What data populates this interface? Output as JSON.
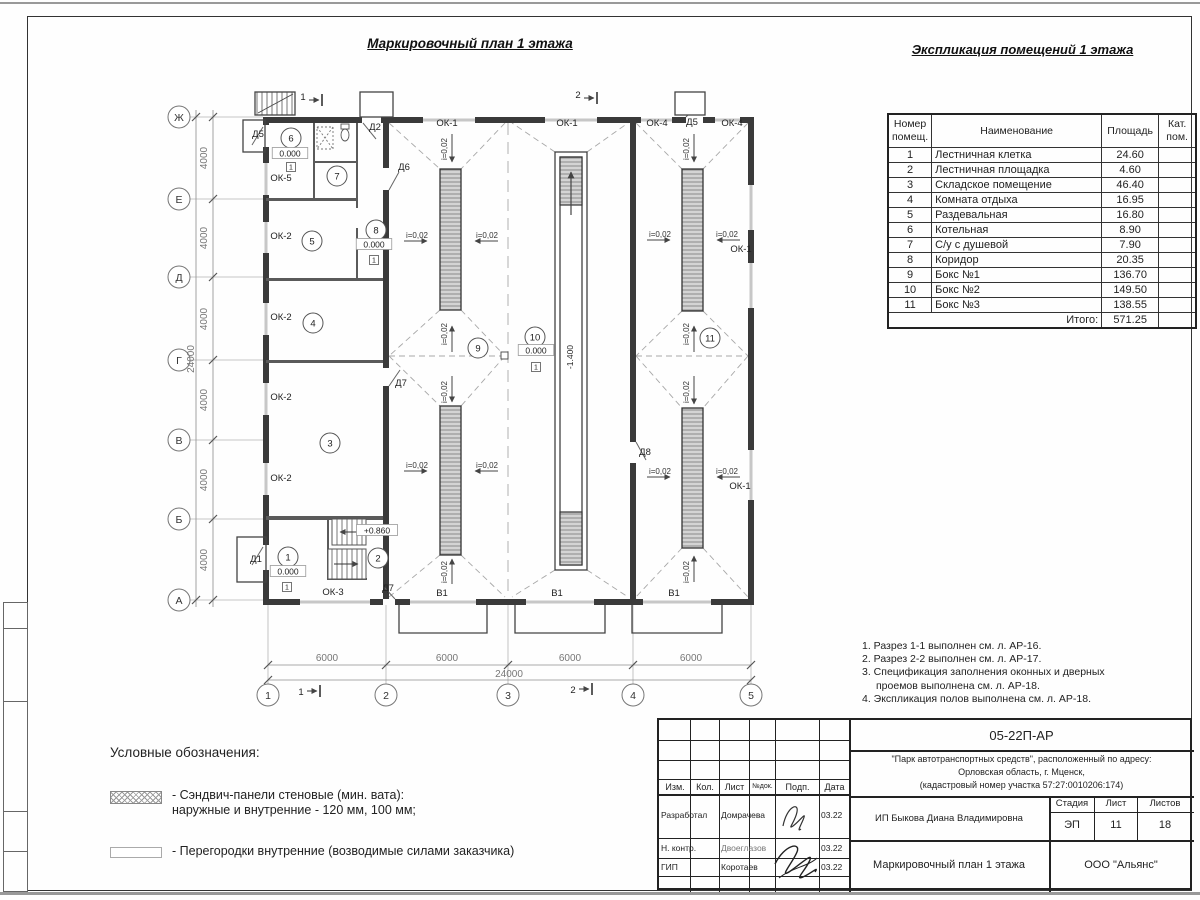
{
  "page": {
    "plan_title": "Маркировочный план 1 этажа",
    "expl_title": "Экспликация помещений 1 этажа"
  },
  "expl_table": {
    "headers": [
      "Номер помещ.",
      "Наименование",
      "Площадь",
      "Кат. пом."
    ],
    "rows": [
      [
        "1",
        "Лестничная клетка",
        "24.60"
      ],
      [
        "2",
        "Лестничная площадка",
        "4.60"
      ],
      [
        "3",
        "Складское помещение",
        "46.40"
      ],
      [
        "4",
        "Комната отдыха",
        "16.95"
      ],
      [
        "5",
        "Раздевальная",
        "16.80"
      ],
      [
        "6",
        "Котельная",
        "8.90"
      ],
      [
        "7",
        "С/у с душевой",
        "7.90"
      ],
      [
        "8",
        "Коридор",
        "20.35"
      ],
      [
        "9",
        "Бокс №1",
        "136.70"
      ],
      [
        "10",
        "Бокс №2",
        "149.50"
      ],
      [
        "11",
        "Бокс №3",
        "138.55"
      ]
    ],
    "total_label": "Итого:",
    "total_value": "571.25"
  },
  "notes": [
    "1. Разрез 1-1 выполнен см. л. АР-16.",
    "2. Разрез 2-2 выполнен см. л. АР-17.",
    "3. Спецификация заполнения оконных и дверных",
    "проемов выполнена см. л. АР-18.",
    "4. Экспликация полов выполнена см. л. АР-18."
  ],
  "legend": {
    "title": "Условные обозначения:",
    "item1_line1": "- Сэндвич-панели стеновые (мин. вата):",
    "item1_line2": "наружные и внутренние - 120 мм, 100 мм;",
    "item2": "- Перегородки внутренние (возводимые силами заказчика)"
  },
  "titleblock": {
    "doc_number": "05-22П-АР",
    "project_line1": "\"Парк автотранспортных средств\",  расположенный по адресу:",
    "project_line2": "Орловская область, г. Мценск,",
    "project_line3": "(кадастровый номер участка 57:27:0010206:174)",
    "client": "ИП Быкова Диана Владимировна",
    "sheet_title": "Маркировочный план 1 этажа",
    "company": "ООО \"Альянс\"",
    "cols": [
      "Изм.",
      "Кол.",
      "Лист",
      "№док.",
      "Подп.",
      "Дата"
    ],
    "stage_label": "Стадия",
    "sheet_label": "Лист",
    "sheets_label": "Листов",
    "stage": "ЭП",
    "sheet_no": "11",
    "sheets_total": "18",
    "people": [
      {
        "role": "Разработал",
        "name": "Домрачева",
        "date": "03.22"
      },
      {
        "role": "Н. контр.",
        "name": "Двоеглазов",
        "date": "03.22"
      },
      {
        "role": "ГИП",
        "name": "Коротаев",
        "date": "03.22"
      }
    ]
  },
  "plan": {
    "axes_rows": [
      [
        "Ж",
        117
      ],
      [
        "Е",
        199
      ],
      [
        "Д",
        277
      ],
      [
        "Г",
        360
      ],
      [
        "В",
        440
      ],
      [
        "Б",
        519
      ],
      [
        "А",
        600
      ]
    ],
    "axes_cols": [
      [
        "1",
        268
      ],
      [
        "2",
        386
      ],
      [
        "3",
        508
      ],
      [
        "4",
        633
      ],
      [
        "5",
        751
      ]
    ],
    "dims_v": [
      [
        "4000",
        207,
        158
      ],
      [
        "4000",
        207,
        238
      ],
      [
        "4000",
        207,
        319
      ],
      [
        "4000",
        207,
        400
      ],
      [
        "4000",
        207,
        480
      ],
      [
        "4000",
        207,
        560
      ],
      [
        "24000",
        194,
        359
      ]
    ],
    "dims_h": [
      [
        "6000",
        327,
        661
      ],
      [
        "6000",
        447,
        661
      ],
      [
        "6000",
        570,
        661
      ],
      [
        "6000",
        691,
        661
      ],
      [
        "24000",
        509,
        677
      ]
    ],
    "marks": [
      [
        "ОК-5",
        281,
        181
      ],
      [
        "ОК-2",
        281,
        239
      ],
      [
        "ОК-2",
        281,
        320
      ],
      [
        "ОК-2",
        281,
        400
      ],
      [
        "ОК-2",
        281,
        481
      ],
      [
        "ОК-3",
        333,
        595
      ],
      [
        "ОК-1",
        447,
        126
      ],
      [
        "ОК-1",
        567,
        126
      ],
      [
        "ОК-4",
        657,
        126
      ],
      [
        "Д5",
        692,
        125
      ],
      [
        "ОК-4",
        732,
        126
      ],
      [
        "Д5",
        258,
        137
      ],
      [
        "Д2",
        375,
        130
      ],
      [
        "Д6",
        404,
        170
      ],
      [
        "Д7",
        401,
        386
      ],
      [
        "Д7",
        388,
        591
      ],
      [
        "Д1",
        256,
        562
      ],
      [
        "Д8",
        645,
        455
      ],
      [
        "ОК-1",
        741,
        252
      ],
      [
        "ОК-1",
        740,
        489
      ],
      [
        "В1",
        442,
        596
      ],
      [
        "В1",
        557,
        596
      ],
      [
        "В1",
        674,
        596
      ],
      [
        "1",
        303,
        100
      ],
      [
        "2",
        578,
        98
      ],
      [
        "1",
        301,
        695
      ],
      [
        "2",
        573,
        693
      ]
    ],
    "slope_label": "i=0,02",
    "slopes_h": [
      [
        417,
        238
      ],
      [
        487,
        238
      ],
      [
        417,
        468
      ],
      [
        487,
        468
      ],
      [
        660,
        237
      ],
      [
        727,
        237
      ],
      [
        660,
        474
      ],
      [
        727,
        474
      ]
    ],
    "slopes_v": [
      [
        447,
        149
      ],
      [
        447,
        334
      ],
      [
        447,
        392
      ],
      [
        447,
        572
      ],
      [
        689,
        149
      ],
      [
        689,
        334
      ],
      [
        689,
        392
      ],
      [
        689,
        572
      ]
    ],
    "rooms": [
      [
        "1",
        288,
        557
      ],
      [
        "2",
        378,
        558
      ],
      [
        "3",
        330,
        443
      ],
      [
        "4",
        313,
        323
      ],
      [
        "5",
        312,
        241
      ],
      [
        "6",
        291,
        138
      ],
      [
        "7",
        337,
        176
      ],
      [
        "8",
        376,
        230
      ],
      [
        "9",
        478,
        348
      ],
      [
        "10",
        535,
        337
      ],
      [
        "11",
        710,
        338
      ]
    ],
    "elevs": [
      [
        "0.000",
        290,
        156
      ],
      [
        "0.000",
        374,
        247
      ],
      [
        "0.000",
        288,
        574
      ],
      [
        "0.000",
        536,
        353
      ],
      [
        "+0.860",
        377,
        533
      ]
    ],
    "elev_rot": [
      "-1.400",
      573,
      357
    ],
    "floor_mark_label": "1",
    "floor_marks": [
      [
        291,
        167
      ],
      [
        374,
        260
      ],
      [
        287,
        587
      ],
      [
        536,
        367
      ]
    ]
  }
}
